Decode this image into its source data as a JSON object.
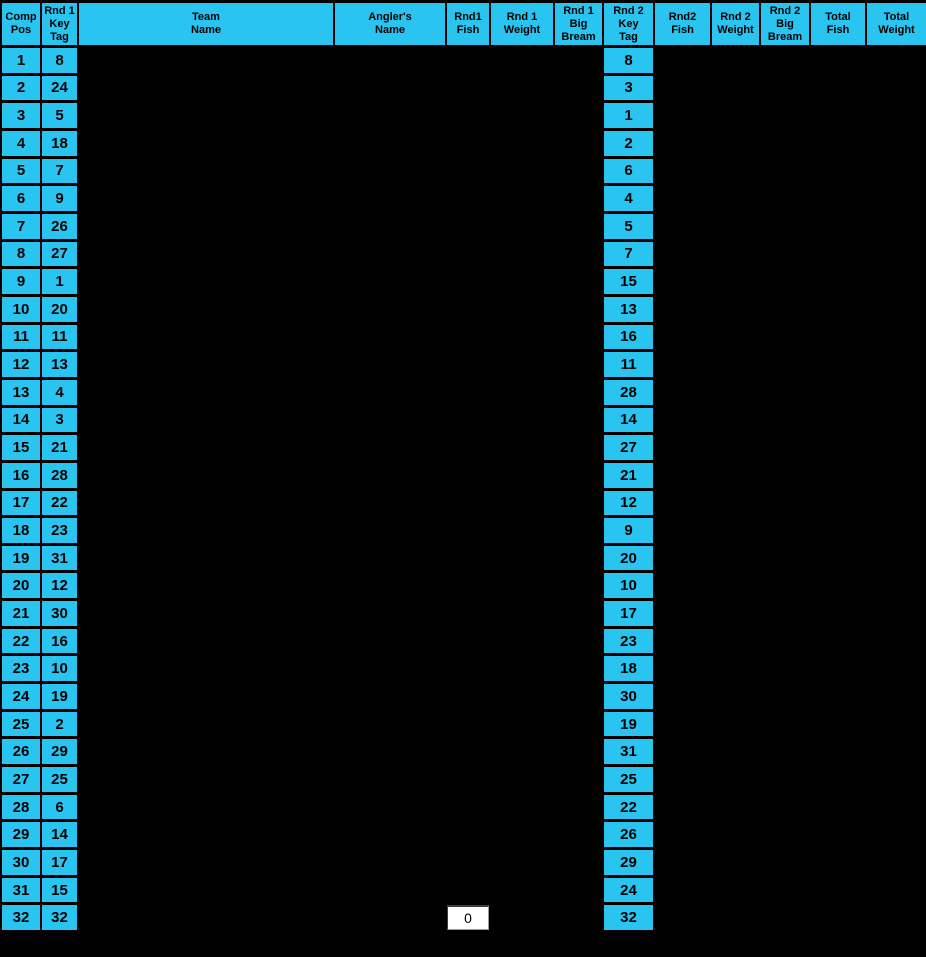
{
  "window": {
    "background": "#000000"
  },
  "table": {
    "colors": {
      "accent": "#29C4F0",
      "grid": "#000000",
      "cell_text": "#000000",
      "active_cell_bg": "#FFFFFF"
    },
    "columns": [
      {
        "key": "comp_pos",
        "label": "Comp\nPos"
      },
      {
        "key": "rnd1_key_tag",
        "label": "Rnd 1\nKey\nTag"
      },
      {
        "key": "team_name",
        "label": "Team\nName"
      },
      {
        "key": "anglers_name",
        "label": "Angler's\nName"
      },
      {
        "key": "rnd1_fish",
        "label": "Rnd1\nFish"
      },
      {
        "key": "rnd1_weight",
        "label": "Rnd 1\nWeight"
      },
      {
        "key": "rnd1_big_bream",
        "label": "Rnd 1\nBig\nBream"
      },
      {
        "key": "rnd2_key_tag",
        "label": "Rnd 2\nKey\nTag"
      },
      {
        "key": "rnd2_fish",
        "label": "Rnd2\nFish"
      },
      {
        "key": "rnd2_weight",
        "label": "Rnd 2\nWeight"
      },
      {
        "key": "rnd2_big_bream",
        "label": "Rnd 2\nBig\nBream"
      },
      {
        "key": "total_fish",
        "label": "Total\nFish"
      },
      {
        "key": "total_weight",
        "label": "Total\nWeight"
      }
    ],
    "rows": [
      {
        "comp_pos": "1",
        "rnd1_key_tag": "8",
        "rnd2_key_tag": "8"
      },
      {
        "comp_pos": "2",
        "rnd1_key_tag": "24",
        "rnd2_key_tag": "3"
      },
      {
        "comp_pos": "3",
        "rnd1_key_tag": "5",
        "rnd2_key_tag": "1"
      },
      {
        "comp_pos": "4",
        "rnd1_key_tag": "18",
        "rnd2_key_tag": "2"
      },
      {
        "comp_pos": "5",
        "rnd1_key_tag": "7",
        "rnd2_key_tag": "6"
      },
      {
        "comp_pos": "6",
        "rnd1_key_tag": "9",
        "rnd2_key_tag": "4"
      },
      {
        "comp_pos": "7",
        "rnd1_key_tag": "26",
        "rnd2_key_tag": "5"
      },
      {
        "comp_pos": "8",
        "rnd1_key_tag": "27",
        "rnd2_key_tag": "7"
      },
      {
        "comp_pos": "9",
        "rnd1_key_tag": "1",
        "rnd2_key_tag": "15"
      },
      {
        "comp_pos": "10",
        "rnd1_key_tag": "20",
        "rnd2_key_tag": "13"
      },
      {
        "comp_pos": "11",
        "rnd1_key_tag": "11",
        "rnd2_key_tag": "16"
      },
      {
        "comp_pos": "12",
        "rnd1_key_tag": "13",
        "rnd2_key_tag": "11"
      },
      {
        "comp_pos": "13",
        "rnd1_key_tag": "4",
        "rnd2_key_tag": "28"
      },
      {
        "comp_pos": "14",
        "rnd1_key_tag": "3",
        "rnd2_key_tag": "14"
      },
      {
        "comp_pos": "15",
        "rnd1_key_tag": "21",
        "rnd2_key_tag": "27"
      },
      {
        "comp_pos": "16",
        "rnd1_key_tag": "28",
        "rnd2_key_tag": "21"
      },
      {
        "comp_pos": "17",
        "rnd1_key_tag": "22",
        "rnd2_key_tag": "12"
      },
      {
        "comp_pos": "18",
        "rnd1_key_tag": "23",
        "rnd2_key_tag": "9"
      },
      {
        "comp_pos": "19",
        "rnd1_key_tag": "31",
        "rnd2_key_tag": "20"
      },
      {
        "comp_pos": "20",
        "rnd1_key_tag": "12",
        "rnd2_key_tag": "10"
      },
      {
        "comp_pos": "21",
        "rnd1_key_tag": "30",
        "rnd2_key_tag": "17"
      },
      {
        "comp_pos": "22",
        "rnd1_key_tag": "16",
        "rnd2_key_tag": "23"
      },
      {
        "comp_pos": "23",
        "rnd1_key_tag": "10",
        "rnd2_key_tag": "18"
      },
      {
        "comp_pos": "24",
        "rnd1_key_tag": "19",
        "rnd2_key_tag": "30"
      },
      {
        "comp_pos": "25",
        "rnd1_key_tag": "2",
        "rnd2_key_tag": "19"
      },
      {
        "comp_pos": "26",
        "rnd1_key_tag": "29",
        "rnd2_key_tag": "31"
      },
      {
        "comp_pos": "27",
        "rnd1_key_tag": "25",
        "rnd2_key_tag": "25"
      },
      {
        "comp_pos": "28",
        "rnd1_key_tag": "6",
        "rnd2_key_tag": "22"
      },
      {
        "comp_pos": "29",
        "rnd1_key_tag": "14",
        "rnd2_key_tag": "26"
      },
      {
        "comp_pos": "30",
        "rnd1_key_tag": "17",
        "rnd2_key_tag": "29"
      },
      {
        "comp_pos": "31",
        "rnd1_key_tag": "15",
        "rnd2_key_tag": "24"
      },
      {
        "comp_pos": "32",
        "rnd1_key_tag": "32",
        "rnd2_key_tag": "32"
      }
    ]
  },
  "active_cell": {
    "row": 32,
    "column": "rnd1_fish",
    "value": "0"
  }
}
